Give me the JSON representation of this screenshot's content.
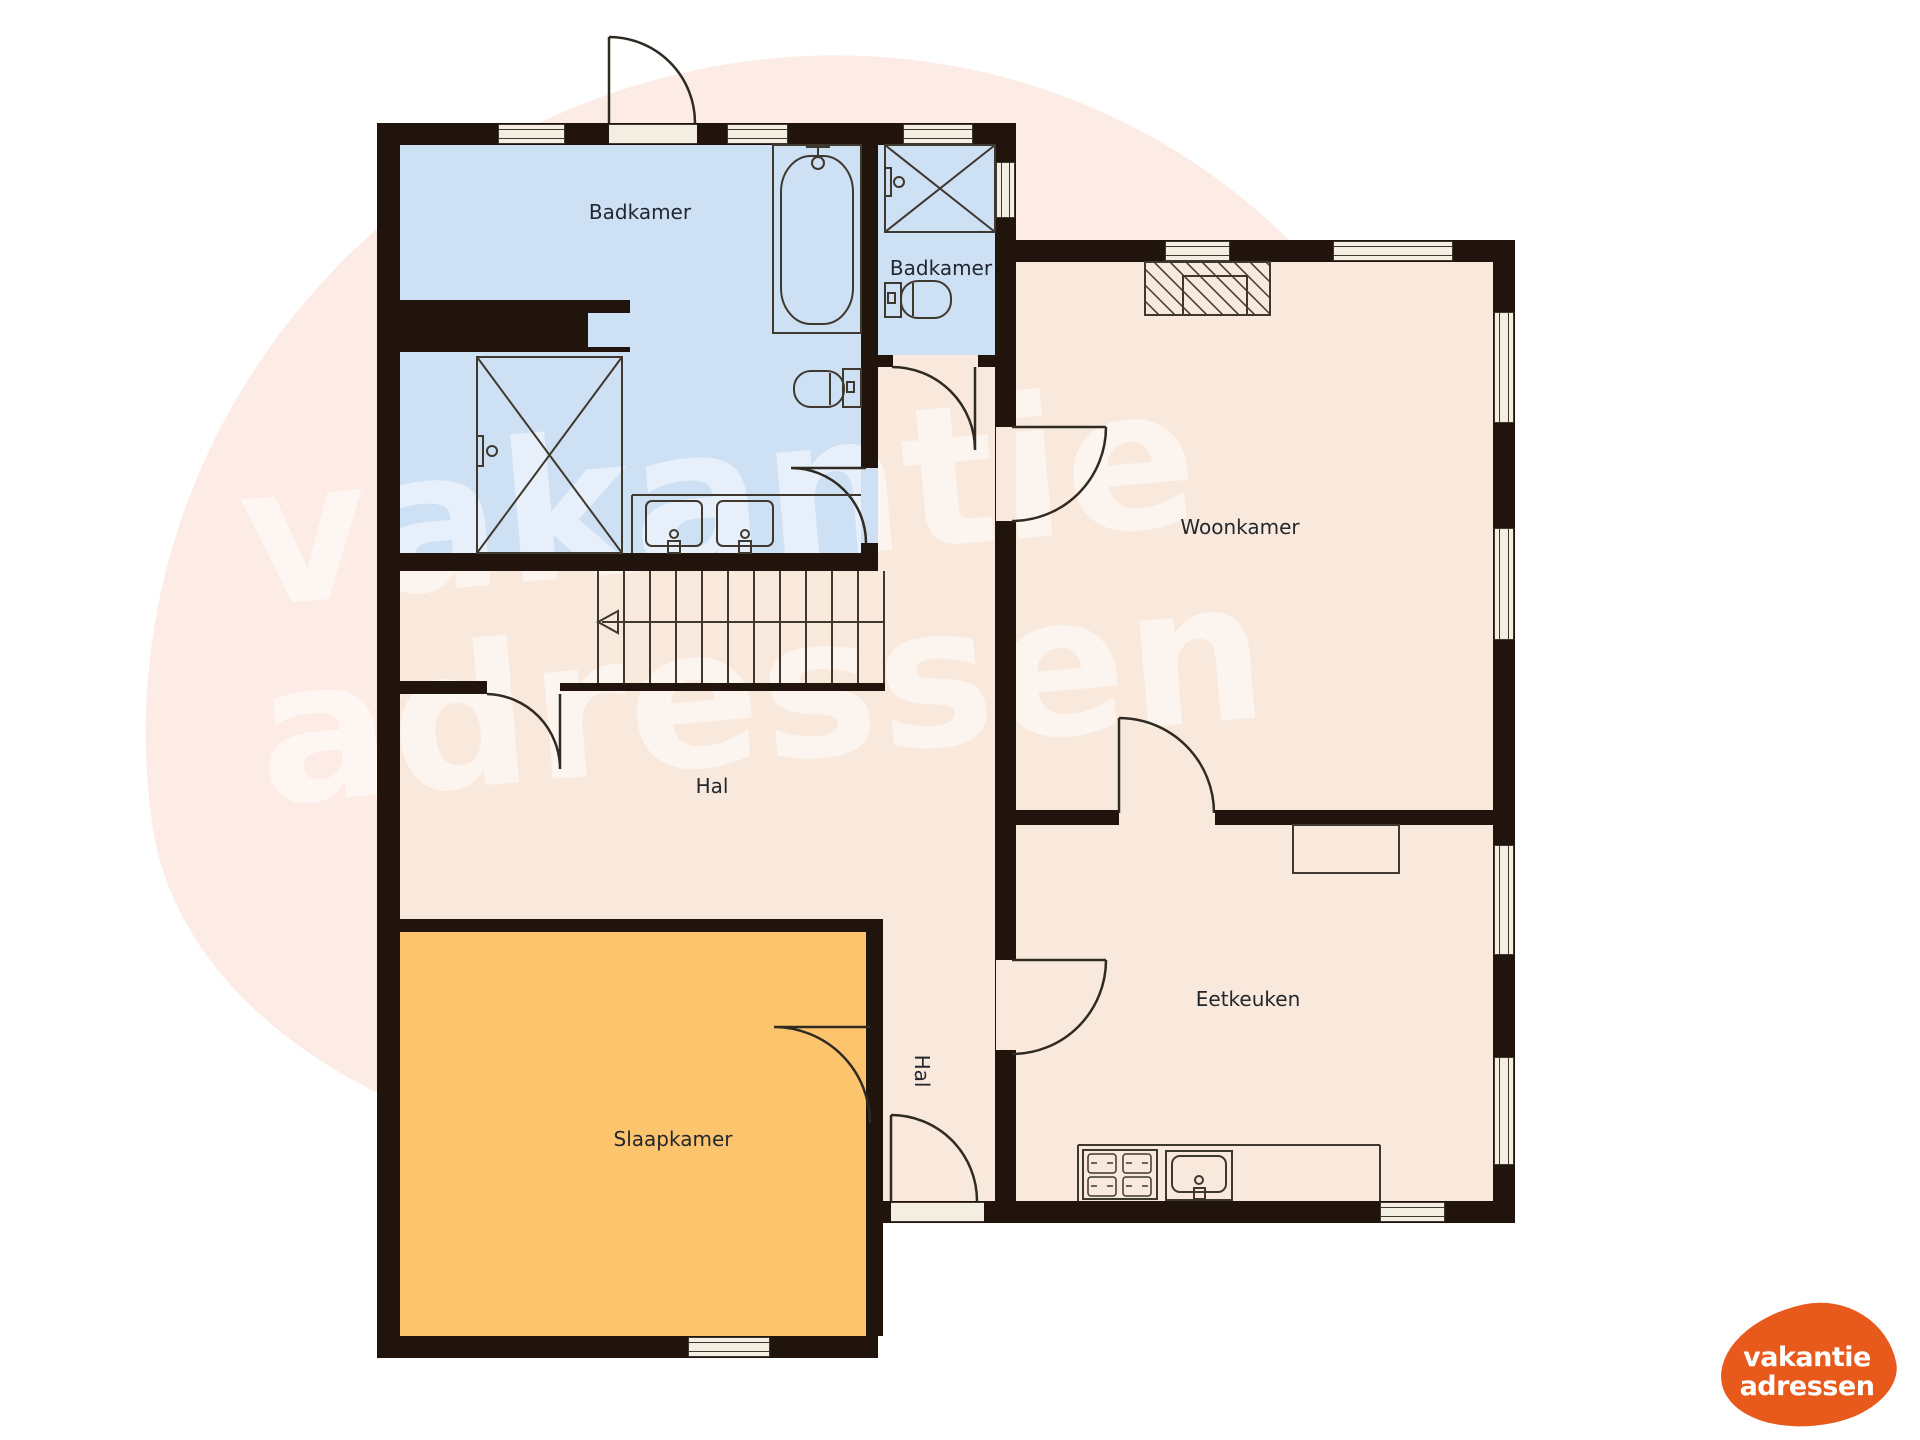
{
  "rooms": [
    {
      "name": "badkamer-1",
      "label": "Badkamer"
    },
    {
      "name": "badkamer-2",
      "label": "Badkamer"
    },
    {
      "name": "woonkamer",
      "label": "Woonkamer"
    },
    {
      "name": "hal",
      "label": "Hal"
    },
    {
      "name": "slaapkamer",
      "label": "Slaapkamer"
    },
    {
      "name": "eetkeuken",
      "label": "Eetkeuken"
    },
    {
      "name": "hal-klein",
      "label": "Hal"
    }
  ],
  "watermark": {
    "line1": "vakantie",
    "line2": "adressen"
  },
  "logo": {
    "line1": "vakantie",
    "line2": "adressen"
  },
  "colors": {
    "wall": "#20140c",
    "bathroom_floor": "#cde0f4",
    "room_floor": "#f9e9dc",
    "bedroom_floor": "#fcc46d",
    "window_frame": "#f3eee1",
    "logo_orange": "#e8591c",
    "background_blob": "#fcece5"
  }
}
